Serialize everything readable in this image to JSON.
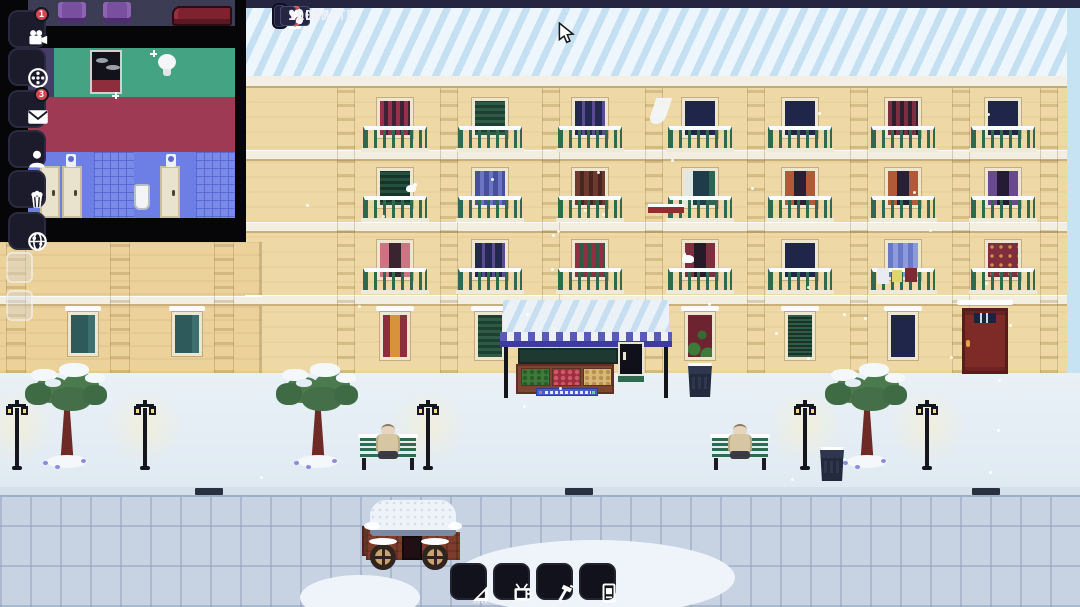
{
  "hud": {
    "date": "1906",
    "time": "08:07",
    "population": "0",
    "film_limit": "ILLIMITE",
    "hearts": "100",
    "controls": [
      {
        "id": "pause",
        "icon": "pause-icon"
      },
      {
        "id": "play",
        "icon": "play-icon"
      },
      {
        "id": "fast-forward",
        "icon": "fast-forward-icon",
        "active": true,
        "glyph": "»"
      }
    ],
    "sound_icons": [
      "music-note-icon",
      "music-notes-icon",
      "compass-icon",
      "record-icon"
    ],
    "note1": "♪",
    "note2": "♫",
    "heart_glyph": "♥",
    "accent_red": "#c4424a"
  },
  "sidebar": {
    "items": [
      {
        "id": "camera",
        "icon": "movie-camera-icon",
        "badge": "1"
      },
      {
        "id": "films",
        "icon": "film-reel-icon",
        "badge": ""
      },
      {
        "id": "mail",
        "icon": "envelope-icon",
        "badge": "3"
      },
      {
        "id": "staff",
        "icon": "person-icon",
        "badge": ""
      },
      {
        "id": "concessions",
        "icon": "popcorn-icon",
        "badge": ""
      },
      {
        "id": "world",
        "icon": "globe-icon",
        "badge": ""
      }
    ]
  },
  "toolbar": {
    "items": [
      {
        "id": "build",
        "icon": "set-square-icon"
      },
      {
        "id": "projector",
        "icon": "projector-icon"
      },
      {
        "id": "construct",
        "icon": "hammer-icon"
      },
      {
        "id": "poster",
        "icon": "poster-icon"
      }
    ]
  },
  "scene": {
    "building": {
      "left": 245,
      "right": 1067,
      "top": 85,
      "band_ys": [
        150,
        222,
        295
      ],
      "row_ys": [
        98,
        168,
        240
      ],
      "col_centers": [
        395,
        490,
        590,
        700,
        800,
        903,
        1003
      ],
      "pilaster_xs": [
        337,
        440,
        542,
        645,
        747,
        850,
        952,
        1040
      ],
      "windows": [
        [
          "red-stripes",
          "green-shutters",
          "navy-purple",
          "navy",
          "navy",
          "maroon-stripes",
          "navy"
        ],
        [
          "dark-green-shutters",
          "blue-shutters",
          "brown-shutters",
          "teal-open",
          "rust-curtains",
          "rust-curtains",
          "plum-curtains"
        ],
        [
          "pink-curtains",
          "navy-purple",
          "red-green",
          "maroon-curtains",
          "navy",
          "blue-curtains",
          "red-floral"
        ]
      ],
      "ground_windows": [
        {
          "col": 0,
          "style": "lit-red"
        },
        {
          "col": 1,
          "style": "green-closed"
        },
        {
          "col": 3,
          "style": "vine-red"
        },
        {
          "col": 4,
          "style": "green-louver"
        },
        {
          "col": 5,
          "style": "navy"
        }
      ],
      "decorations": [
        {
          "type": "bird",
          "x": 406,
          "y": 185
        },
        {
          "type": "flowerbox",
          "x": 648,
          "y": 204
        },
        {
          "type": "curtain",
          "x": 652,
          "y": 98
        },
        {
          "type": "cat",
          "x": 682,
          "y": 255
        },
        {
          "type": "laundry-white",
          "x": 877,
          "y": 268
        },
        {
          "type": "laundry-yellow",
          "x": 892,
          "y": 270
        },
        {
          "type": "laundry-red",
          "x": 905,
          "y": 268
        }
      ]
    },
    "left_building": {
      "window_xs": [
        68,
        172
      ],
      "band_y": 296,
      "pilaster_xs": [
        6,
        110,
        214
      ]
    },
    "street": {
      "curb_marker_xs": [
        195,
        565,
        972
      ],
      "tree_xs": [
        67,
        318,
        867
      ],
      "lamp_xs": [
        17,
        145,
        428,
        805,
        927
      ],
      "bench_xs": [
        388,
        740
      ],
      "bins": [
        {
          "x": 688,
          "y": 363
        },
        {
          "x": 820,
          "y": 447
        }
      ]
    }
  }
}
